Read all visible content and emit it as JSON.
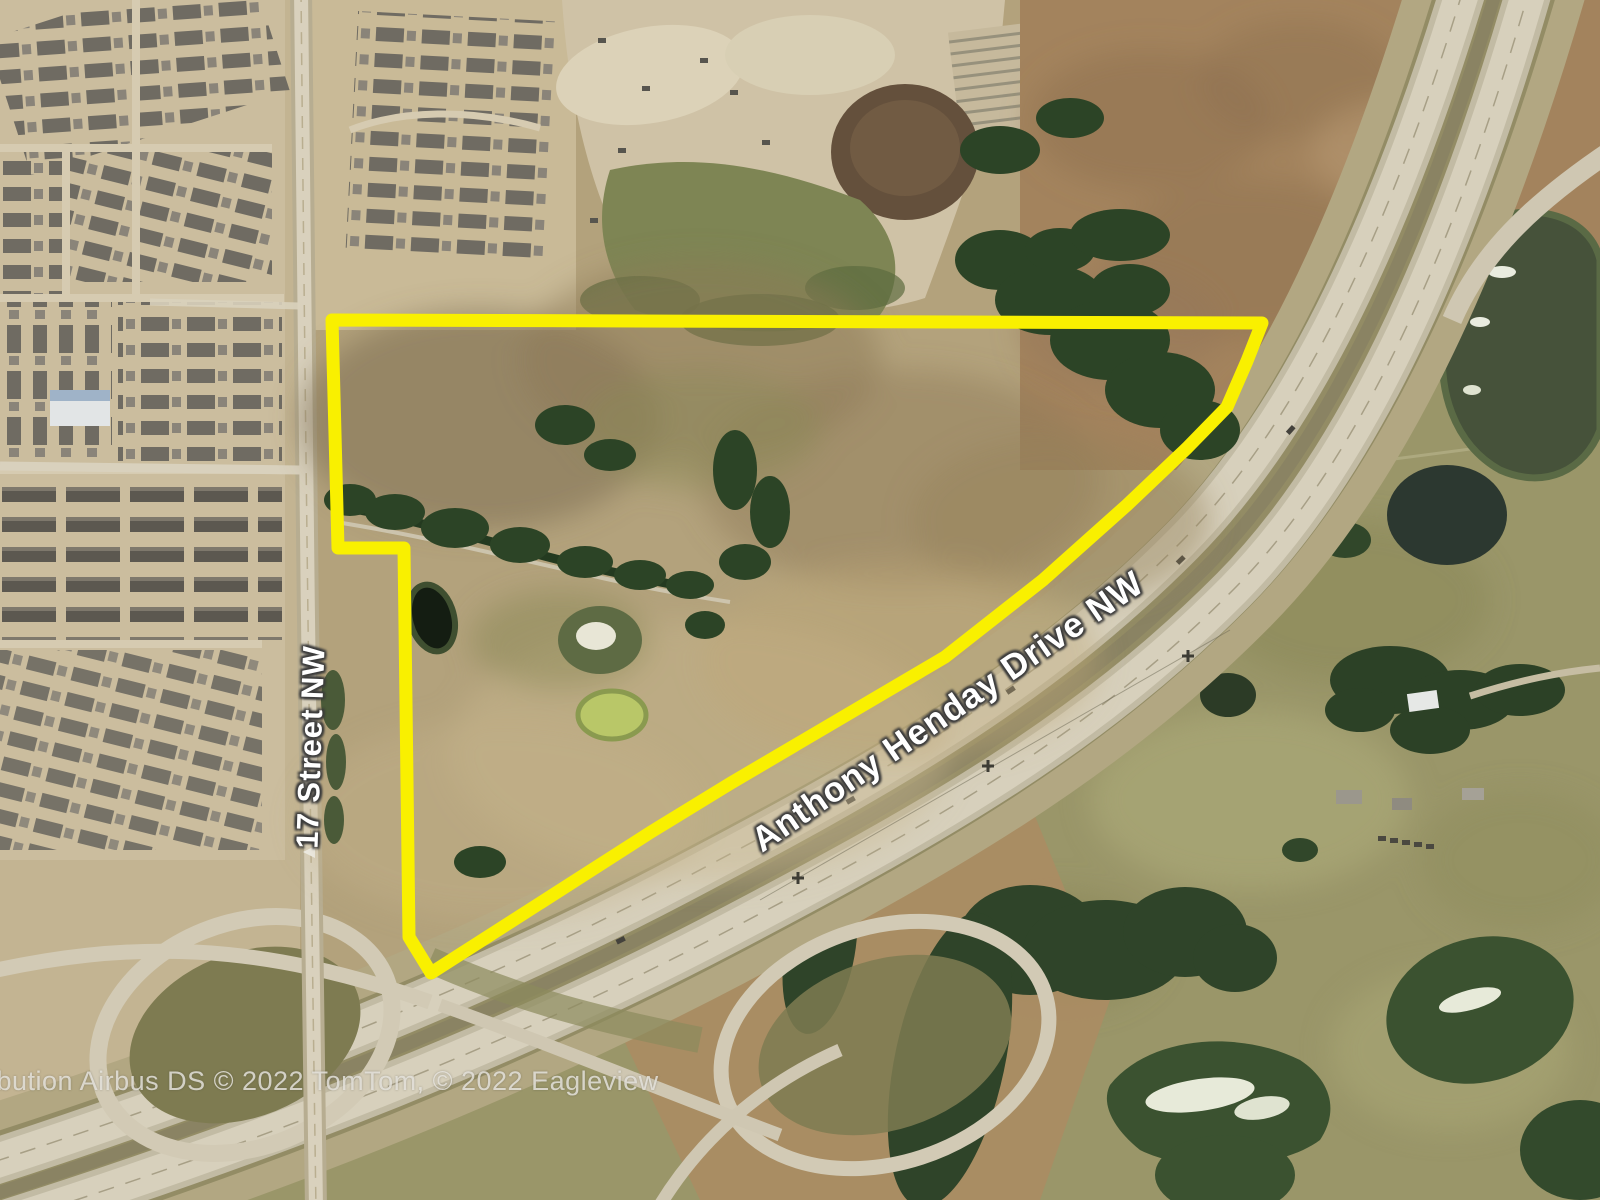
{
  "map": {
    "type": "satellite-aerial-imagery",
    "road_labels": {
      "street": "17 Street NW",
      "highway": "Anthony Henday Drive NW"
    },
    "attribution": "ibution Airbus DS © 2022 TomTom, © 2022 Eagleview",
    "parcel_outline": {
      "color": "#F9F000",
      "stroke_width": 13,
      "points": [
        [
          332,
          320
        ],
        [
          1262,
          323
        ],
        [
          1247,
          361
        ],
        [
          1227,
          407
        ],
        [
          1187,
          448
        ],
        [
          1127,
          505
        ],
        [
          1043,
          580
        ],
        [
          945,
          657
        ],
        [
          731,
          783
        ],
        [
          651,
          832
        ],
        [
          431,
          973
        ],
        [
          409,
          937
        ],
        [
          404,
          548
        ],
        [
          338,
          548
        ]
      ]
    },
    "label_text_color": "#FFFFFF"
  }
}
